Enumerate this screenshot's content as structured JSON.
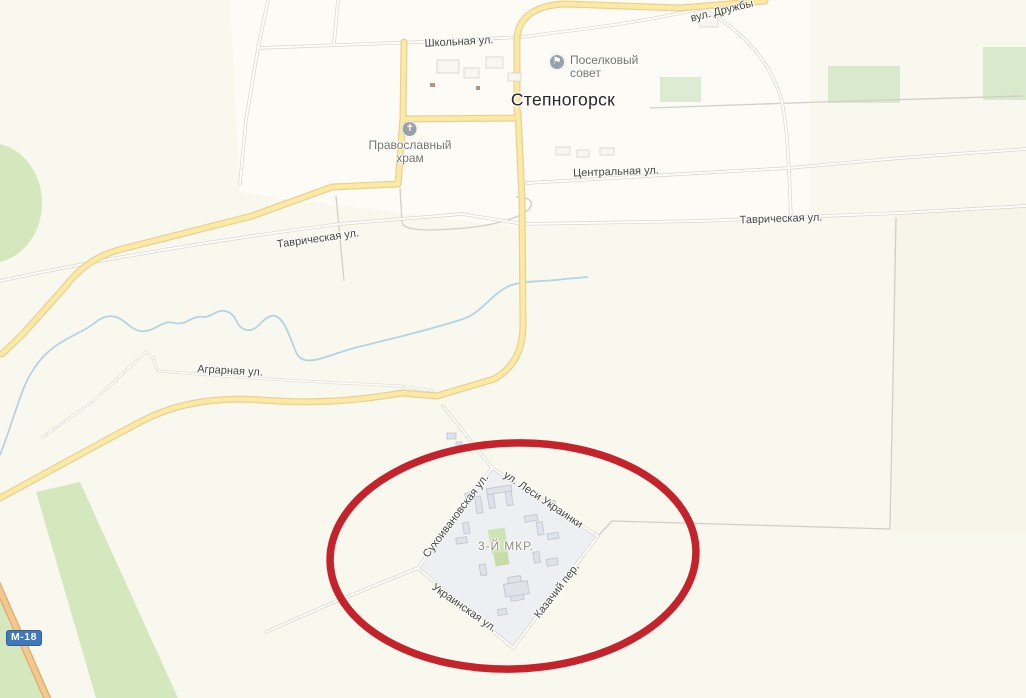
{
  "map": {
    "town_label": "Степногорск",
    "district_label": "3-Й МКР.",
    "road_badge": "М-18",
    "streets": [
      {
        "id": "shkolnaya",
        "text": "Школьная ул."
      },
      {
        "id": "druzhby",
        "text": "вул. Дружбы"
      },
      {
        "id": "centralnaya",
        "text": "Центральная ул."
      },
      {
        "id": "tavricheskaya-west",
        "text": "Таврическая ул."
      },
      {
        "id": "tavricheskaya-east",
        "text": "Таврическая ул."
      },
      {
        "id": "agrarnaya",
        "text": "Аграрная ул."
      },
      {
        "id": "lesi-ukrainki",
        "text": "ул. Леси Украинки"
      },
      {
        "id": "sukhoivanovskaya",
        "text": "Сухоивановская ул."
      },
      {
        "id": "ukrainskaya",
        "text": "Украинская ул."
      },
      {
        "id": "kazachiy",
        "text": "Казачий пер."
      }
    ],
    "pois": [
      {
        "id": "settlement-council",
        "icon": "flag-icon",
        "glyph": "⚑",
        "line1": "Поселковый",
        "line2": "совет"
      },
      {
        "id": "orthodox-church",
        "icon": "cross-icon",
        "glyph": "✝",
        "line1": "Православный",
        "line2": "храм"
      }
    ],
    "annotation": {
      "shape": "ellipse",
      "color": "#c4232b"
    },
    "colors": {
      "land": "#f9f8ef",
      "urban_block": "#edeff2",
      "green_area": "#d5e8bd",
      "main_road": "#fbe9a4",
      "highway": "#f3c88f",
      "water": "#b6d3e4",
      "badge_blue": "#4177bb",
      "annotation_red": "#c4232b"
    }
  }
}
